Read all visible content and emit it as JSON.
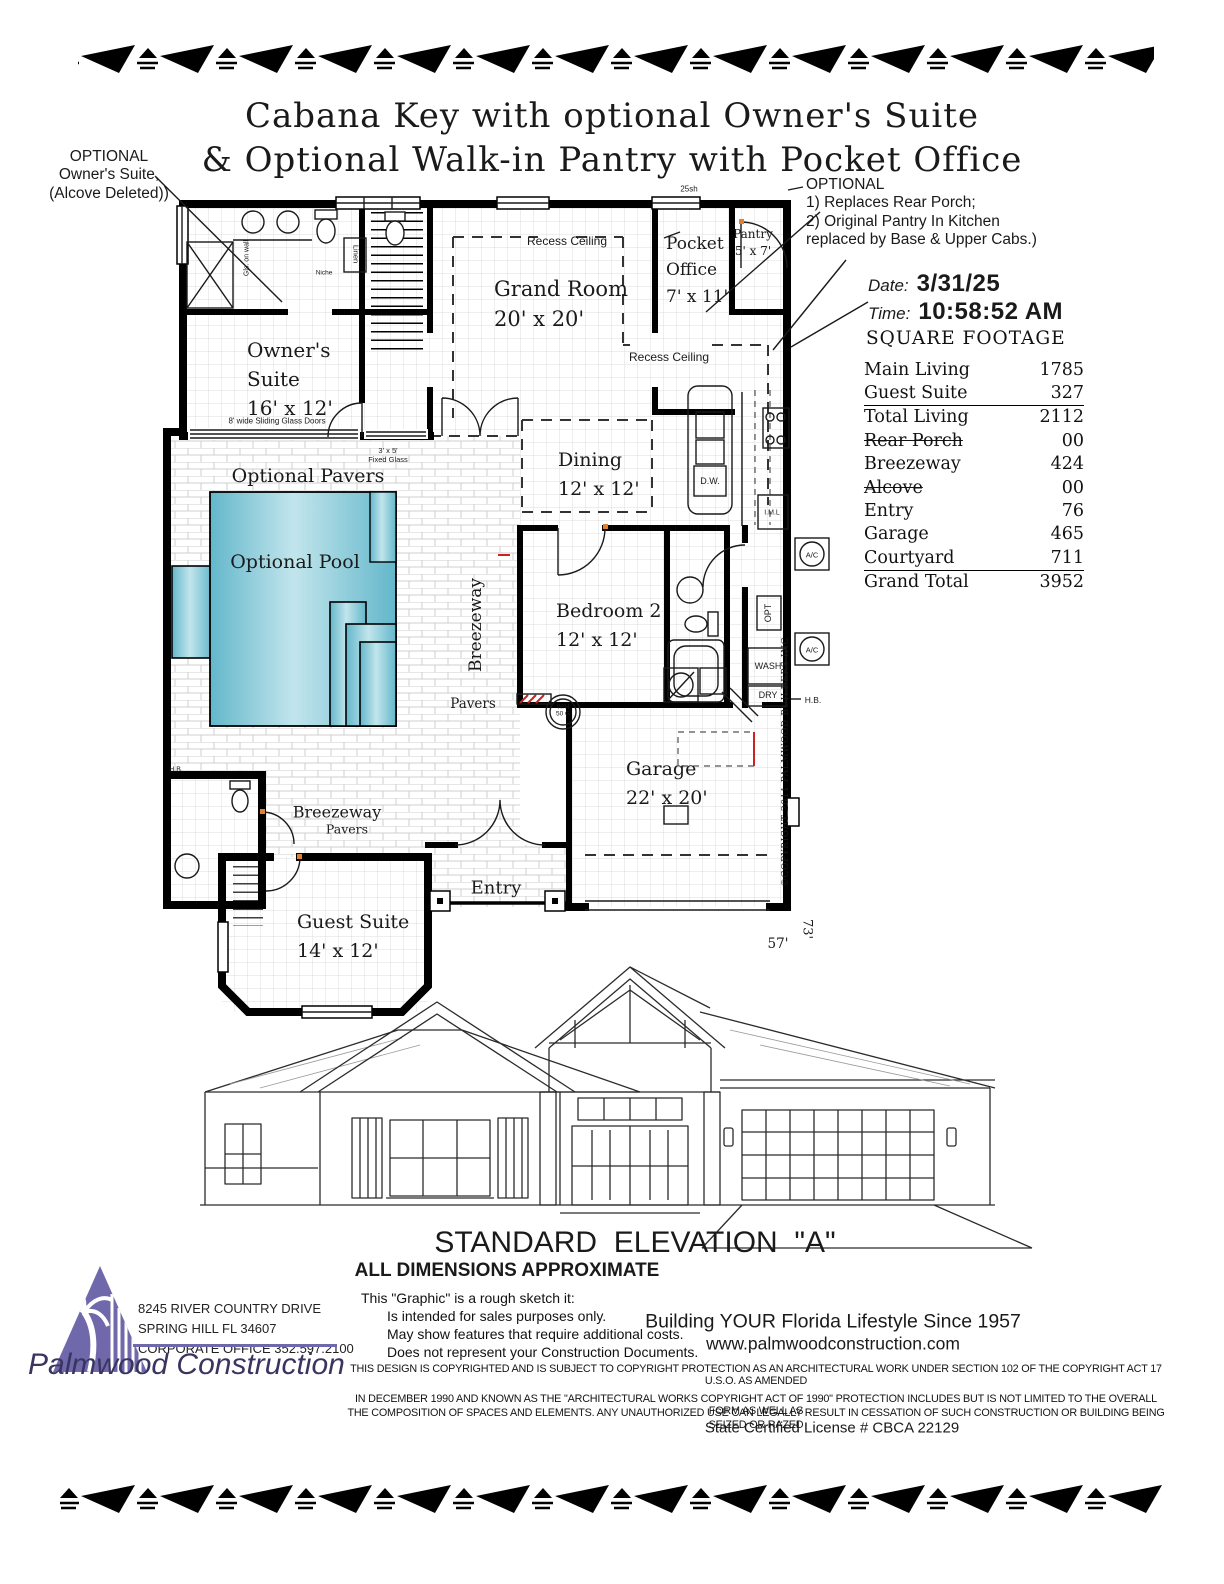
{
  "title": {
    "line1": "Cabana Key with optional Owner's Suite",
    "line2": "& Optional Walk-in Pantry with Pocket Office"
  },
  "annotations": {
    "left": {
      "l1": "OPTIONAL",
      "l2": "Owner's Suite,",
      "l3": "(Alcove Deleted))"
    },
    "right": {
      "l1": "OPTIONAL",
      "l2": "1) Replaces Rear Porch;",
      "l3": "2) Original Pantry In Kitchen",
      "l4": "replaced by Base & Upper Cabs.)"
    }
  },
  "stamp": {
    "date_label": "Date:",
    "date_value": "3/31/25",
    "time_label": "Time:",
    "time_value": "10:58:52 AM"
  },
  "square_footage": {
    "title": "SQUARE FOOTAGE",
    "rows": [
      {
        "label": "Main Living",
        "value": "1785"
      },
      {
        "label": "Guest Suite",
        "value": "327"
      },
      {
        "label": "Total Living",
        "value": "2112"
      },
      {
        "label": "Rear Porch",
        "value": "00"
      },
      {
        "label": "Breezeway",
        "value": "424"
      },
      {
        "label": "Alcove",
        "value": "00"
      },
      {
        "label": "Entry",
        "value": "76"
      },
      {
        "label": "Garage",
        "value": "465"
      },
      {
        "label": "Courtyard",
        "value": "711"
      },
      {
        "label": "Grand Total",
        "value": "3952"
      }
    ]
  },
  "plan": {
    "rooms": {
      "grand_room_name": "Grand Room",
      "grand_room_dims": "20' x 20'",
      "owners_1": "Owner's",
      "owners_2": "Suite",
      "owners_dims": "16' x 12'",
      "pocket_1": "Pocket",
      "pocket_2": "Office",
      "pocket_dims": "7' x 11'",
      "pantry_name": "Pantry",
      "pantry_dims": "5' x 7'",
      "dining_name": "Dining",
      "dining_dims": "12' x 12'",
      "bedroom2_name": "Bedroom 2",
      "bedroom2_dims": "12' x 12'",
      "garage_name": "Garage",
      "garage_dims": "22' x 20'",
      "entry_name": "Entry",
      "guest_name": "Guest Suite",
      "guest_dims": "14' x 12'",
      "optional_pavers": "Optional Pavers",
      "optional_pool": "Optional Pool",
      "breezeway_vertical": "Breezeway",
      "breezeway_south": "Breezeway",
      "pavers_mid": "Pavers",
      "pavers_south": "Pavers"
    },
    "notes": {
      "recess_ceiling": "Recess Ceiling",
      "shelf": "25sh",
      "sliding_doors": "8' wide Sliding Glass Doors",
      "fixed_glass_1": "3' x 5'",
      "fixed_glass_2": "Fixed Glass",
      "dw": "D.W.",
      "wash": "WASH",
      "dry": "DRY",
      "opt": "OPT",
      "ac": "A/C",
      "wh1": "W/H",
      "wh2": "50 G",
      "hb": "H.B.",
      "iml": "I.M.L",
      "linen": "Linen",
      "niche": "Niche",
      "gls": "Gls. on wall",
      "dim_width": "57'",
      "dim_depth": "73'",
      "copyright_vertical": "©COPYRIGHT 2011 PALMWOOD BUILDERS INC"
    },
    "colors": {
      "pool_light": "#c2e5ec",
      "pool_dark": "#63b7cb",
      "red_accent": "#cc2222"
    }
  },
  "elevation": {
    "title": "STANDARD  ELEVATION  \"A\"",
    "subtitle": "ALL DIMENSIONS APPROXIMATE"
  },
  "footer": {
    "address1": "8245 RIVER COUNTRY DRIVE",
    "address2": "SPRING HILL FL 34607",
    "address3": "CORPORATE OFFICE 352.597.2100",
    "company": "Palmwood Construction",
    "note1": "This \"Graphic\" is a rough sketch it:",
    "note2": "Is intended for sales purposes only.",
    "note3": "May show features that require additional costs.",
    "note4": "Does not represent your Construction Documents.",
    "tagline": "Building YOUR Florida Lifestyle Since 1957",
    "website": "www.palmwoodconstruction.com",
    "legal1": "THIS DESIGN IS COPYRIGHTED AND IS SUBJECT TO COPYRIGHT PROTECTION AS AN ARCHITECTURAL WORK UNDER SECTION 102 OF THE COPYRIGHT ACT 17 U.S.O. AS AMENDED",
    "legal2": "IN DECEMBER 1990 AND KNOWN AS THE \"ARCHITECTURAL WORKS COPYRIGHT ACT OF 1990\" PROTECTION INCLUDES BUT IS NOT LIMITED TO THE OVERALL FORM AS WELL AS",
    "legal3": "THE COMPOSITION OF SPACES AND ELEMENTS. ANY UNAUTHORIZED USE CAN LEGALLY RESULT IN CESSATION OF SUCH CONSTRUCTION OR BUILDING BEING SEIZED OR RAZED",
    "license": "State Certified License # CBCA 22129",
    "logo_color": "#6f68ab"
  }
}
